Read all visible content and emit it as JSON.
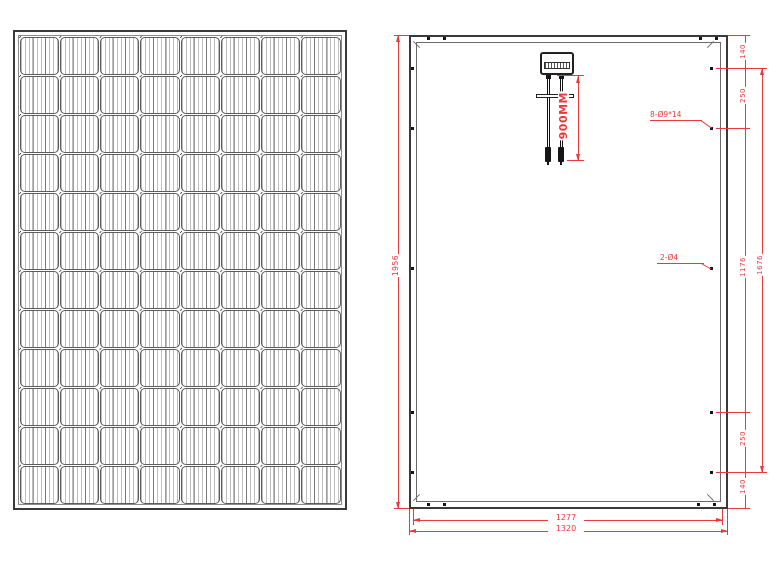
{
  "drawing": {
    "front_view": {
      "name": "solar-module-front-view",
      "rows": 12,
      "columns": 8
    },
    "rear_view": {
      "name": "solar-module-rear-view",
      "labels": {
        "height_total": "1956",
        "right_chain": [
          "140",
          "250",
          "1176",
          "250",
          "140"
        ],
        "hole_span": "1676",
        "mounting_holes": "8-Ø9*14",
        "ground_holes": "2-Ø4",
        "cable_length": "900MM",
        "width_inner": "1277",
        "width_total": "1320"
      }
    },
    "colors": {
      "dimension": "#e8393d",
      "outline": "#3a3a3a"
    }
  }
}
